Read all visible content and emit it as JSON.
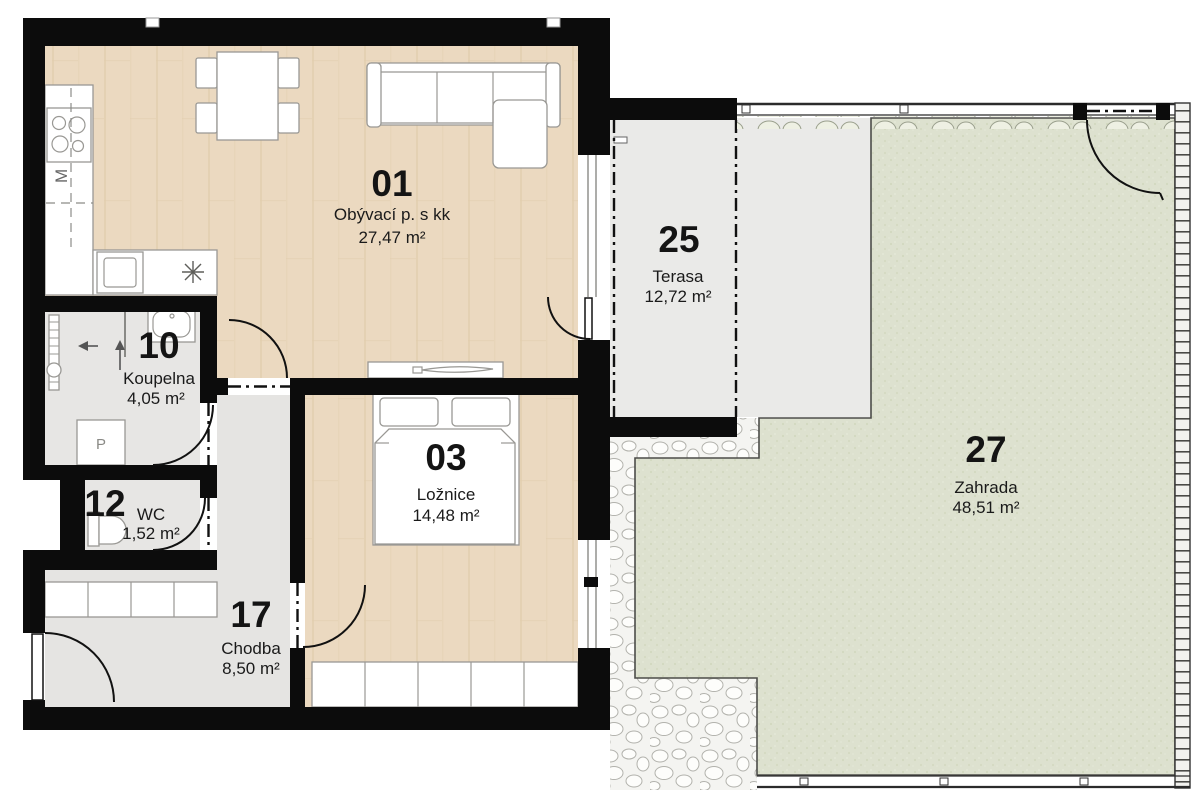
{
  "plan": {
    "title": "Floor plan — apartment with terrace and garden",
    "rooms": [
      {
        "id": "01",
        "name": "Obývací p. s kk",
        "area": "27,47 m²"
      },
      {
        "id": "03",
        "name": "Ložnice",
        "area": "14,48 m²"
      },
      {
        "id": "10",
        "name": "Koupelna",
        "area": "4,05 m²"
      },
      {
        "id": "12",
        "name": "WC",
        "area": "1,52 m²"
      },
      {
        "id": "17",
        "name": "Chodba",
        "area": "8,50 m²"
      },
      {
        "id": "25",
        "name": "Terasa",
        "area": "12,72 m²"
      },
      {
        "id": "27",
        "name": "Zahrada",
        "area": "48,51 m²"
      }
    ],
    "fixtures": {
      "washer_label": "P",
      "kitchen_appliance_label": "M"
    },
    "colors": {
      "wall": "#0c0c0c",
      "wood_floor": "#ebd9c0",
      "gray_floor": "#e7e6e4",
      "terrace": "#eaeae8",
      "garden": "#dde1cf"
    }
  }
}
